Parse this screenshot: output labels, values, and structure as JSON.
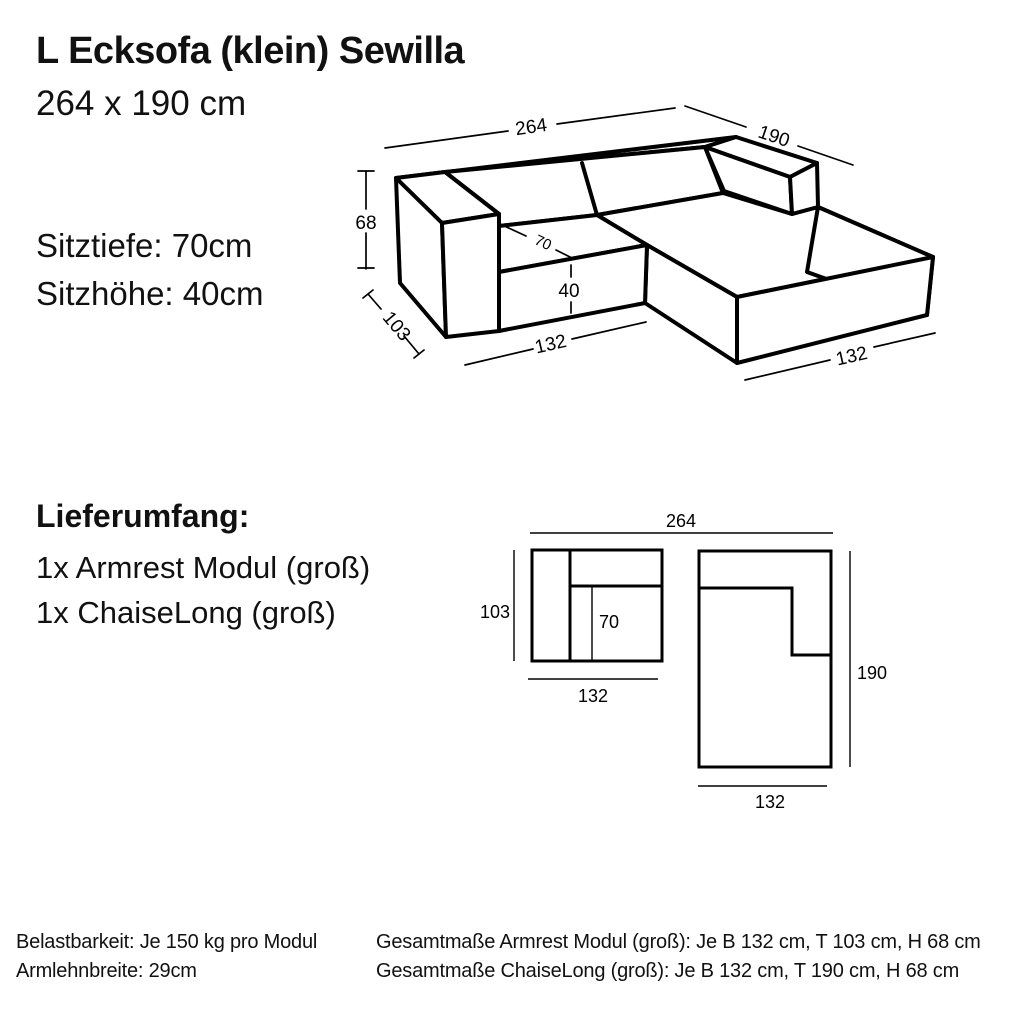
{
  "header": {
    "title": "L Ecksofa (klein) Sewilla",
    "subtitle": "264 x 190 cm"
  },
  "specs": {
    "seat_depth": "Sitztiefe: 70cm",
    "seat_height": "Sitzhöhe: 40cm"
  },
  "iso": {
    "dim_width_total": "264",
    "dim_depth_total": "190",
    "dim_height": "68",
    "dim_depth_module": "103",
    "dim_seat_depth": "70",
    "dim_seat_height": "40",
    "dim_width_left": "132",
    "dim_width_right": "132"
  },
  "delivery": {
    "heading": "Lieferumfang:",
    "items": [
      "1x Armrest Modul (groß)",
      "1x ChaiseLong (groß)"
    ]
  },
  "plan": {
    "dim_width_total": "264",
    "armrest_module": {
      "depth": "103",
      "seat_depth": "70",
      "width": "132"
    },
    "chaise_module": {
      "depth": "190",
      "width": "132"
    }
  },
  "footer": {
    "left": [
      "Belastbarkeit: Je 150 kg pro Modul",
      "Armlehnbreite: 29cm"
    ],
    "right": [
      "Gesamtmaße Armrest Modul (groß): Je B 132 cm, T 103 cm, H 68 cm",
      "Gesamtmaße ChaiseLong (groß): Je B 132 cm, T 190 cm, H 68 cm"
    ]
  },
  "colors": {
    "background": "#ffffff",
    "line": "#000000"
  }
}
